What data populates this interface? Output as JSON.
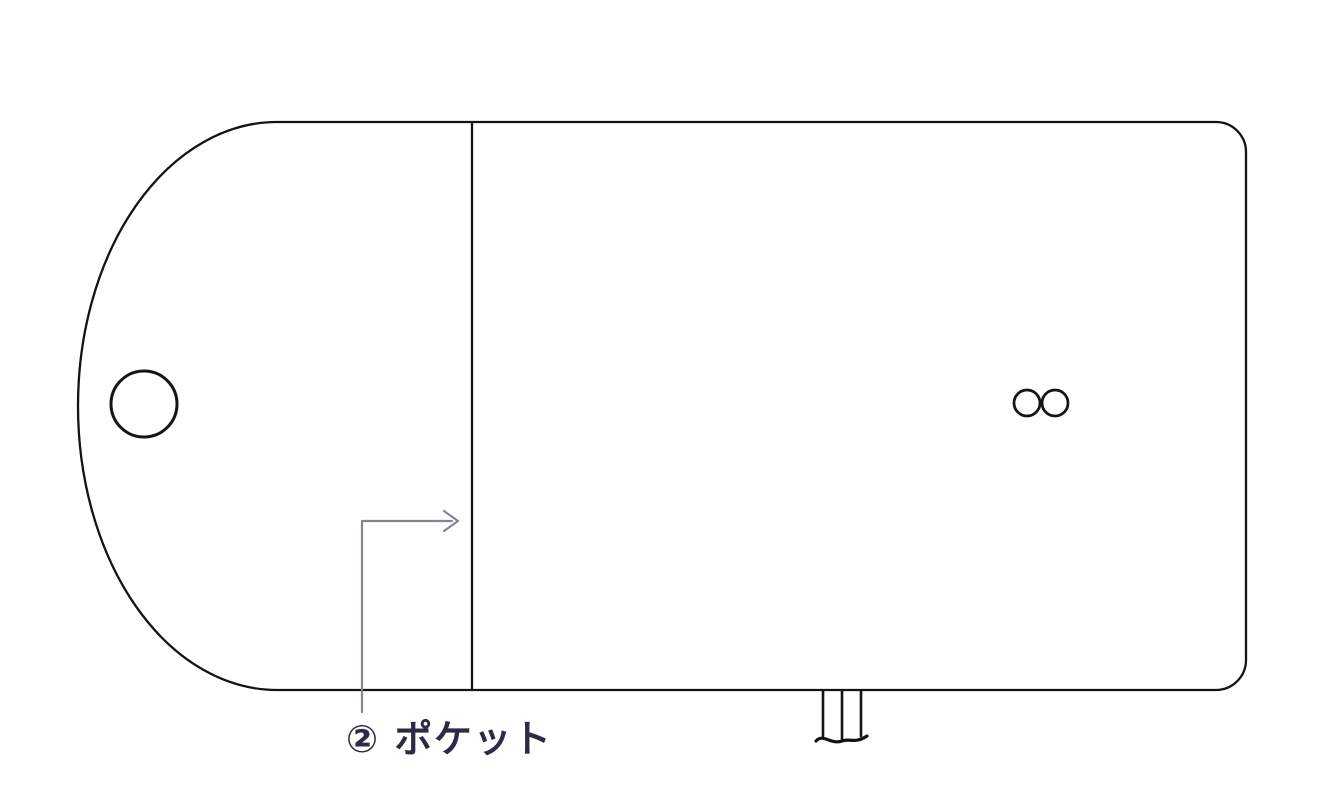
{
  "diagram": {
    "annotations": {
      "pocket_label": "② ポケット"
    }
  },
  "colors": {
    "background": "#ffffff",
    "outline": "#131318",
    "leader_line": "#85858f",
    "label_text": "#2b2b45"
  }
}
